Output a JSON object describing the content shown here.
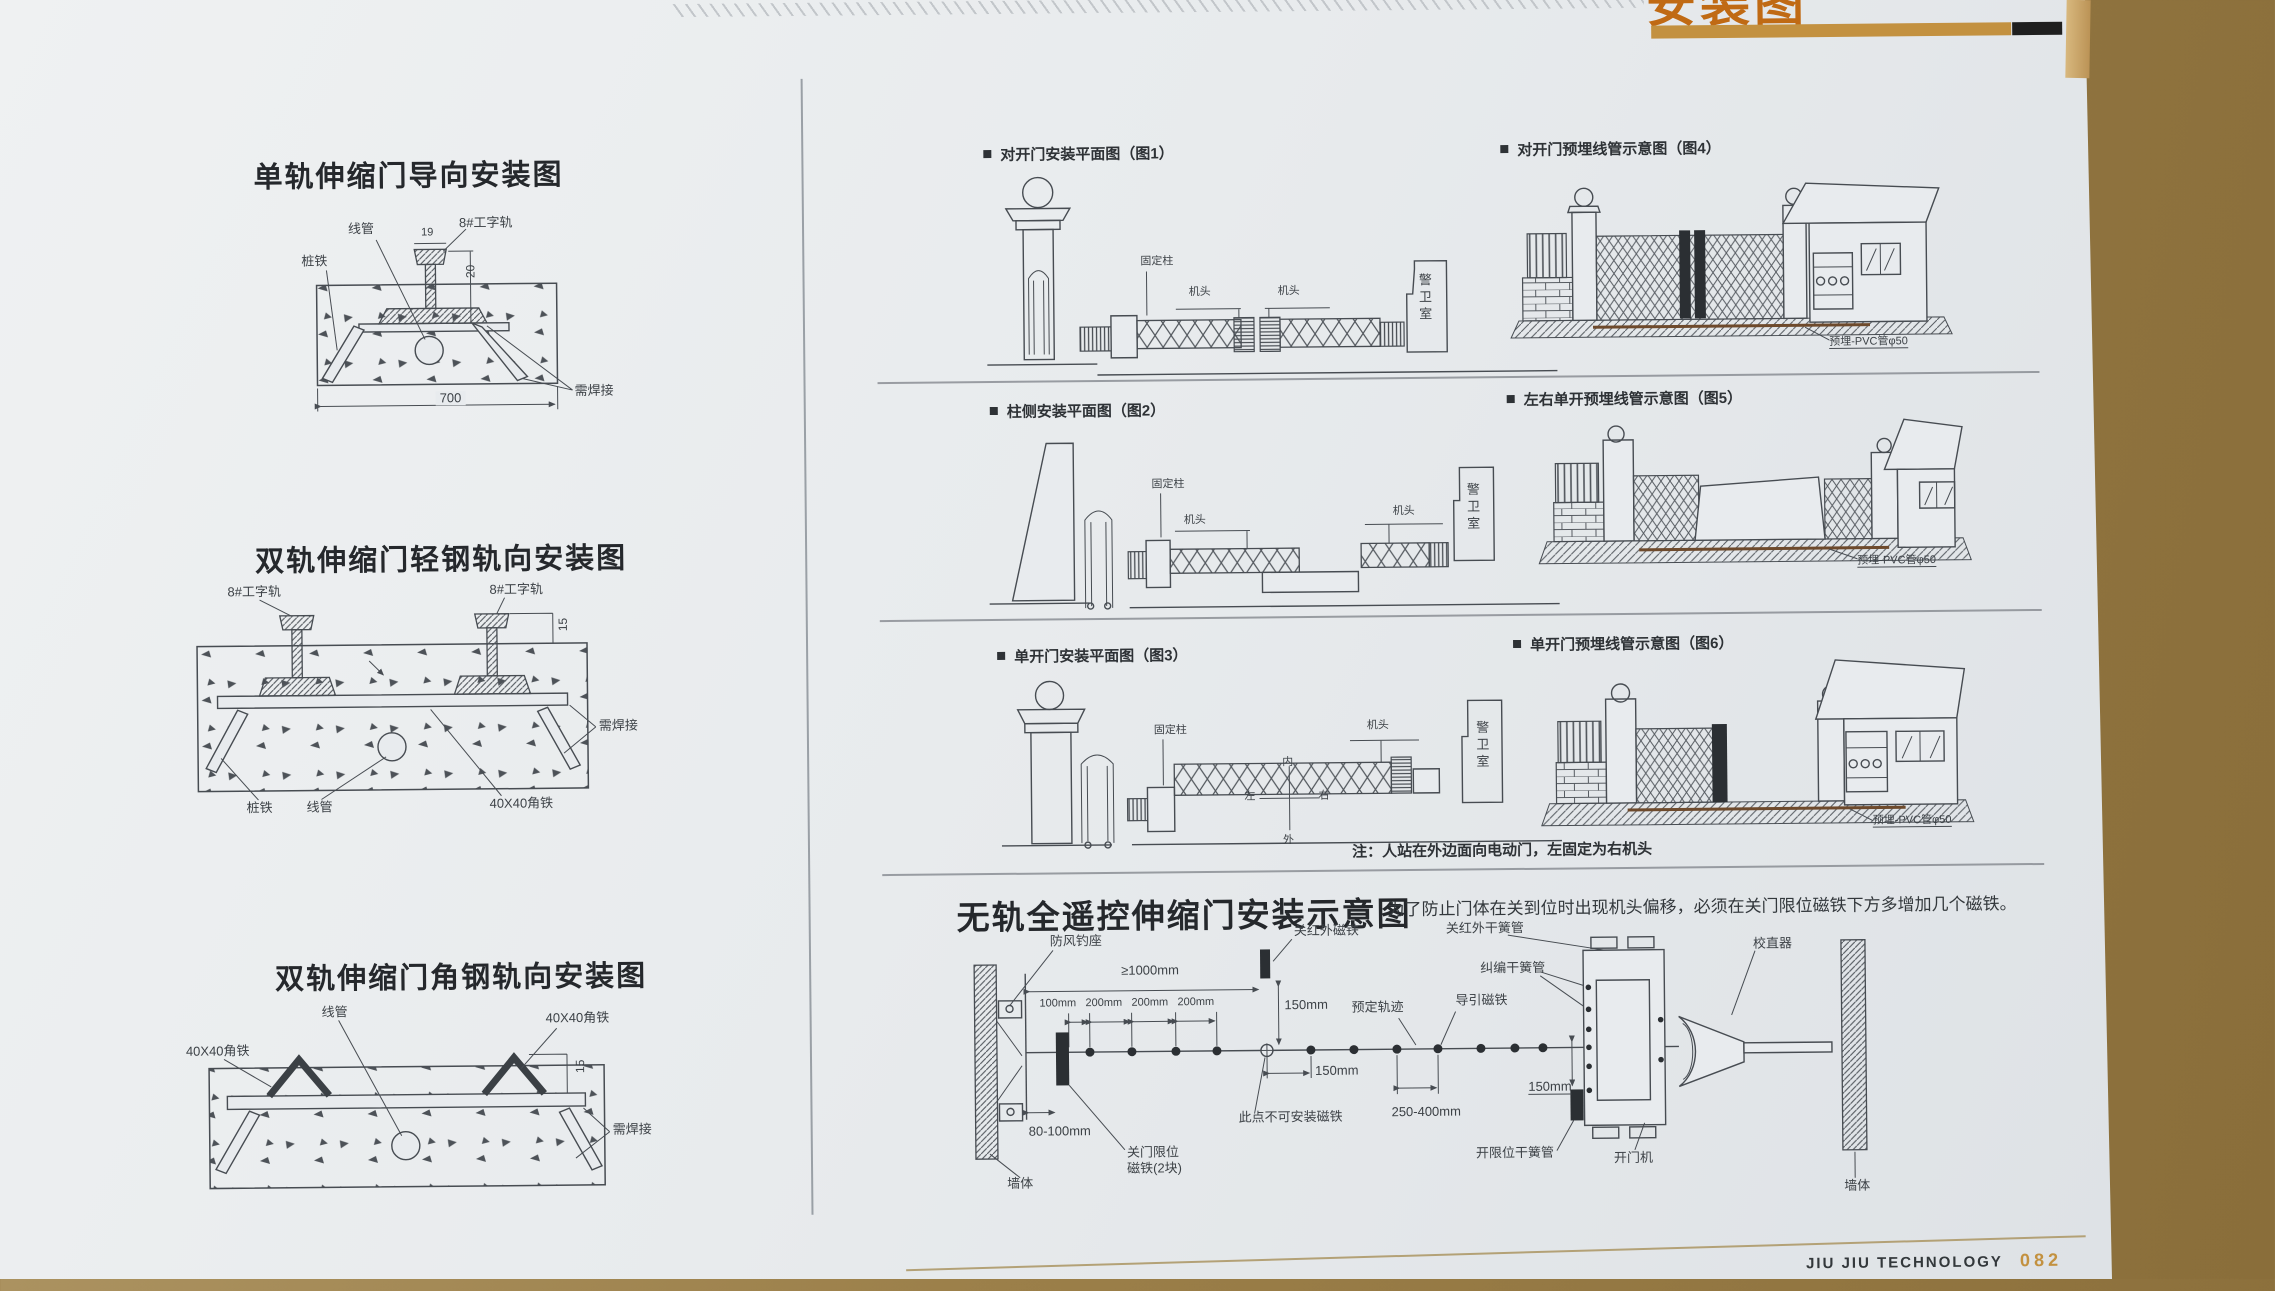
{
  "header": {
    "title_cn": "安装图",
    "title_en": "INSTALLATION DRAWINGS"
  },
  "footer": {
    "brand": "JIU JIU TECHNOLOGY",
    "page": "082"
  },
  "titles": {
    "d1": "单轨伸缩门导向安装图",
    "d2": "双轨伸缩门轻钢轨向安装图",
    "d3": "双轨伸缩门角钢轨向安装图",
    "main": "无轨全遥控伸缩门安装示意图",
    "tip": "为了防止门体在关到位时出现机头偏移，必须在关门限位磁铁下方多增加几个磁铁。",
    "note": "注：人站在外边面向电动门，左固定为右机头"
  },
  "figs": {
    "f1": "对开门安装平面图（图1）",
    "f2": "柱侧安装平面图（图2）",
    "f3": "单开门安装平面图（图3）",
    "f4": "对开门预埋线管示意图（图4）",
    "f5": "左右单开预埋线管示意图（图5）",
    "f6": "单开门预埋线管示意图（图6）"
  },
  "labels": {
    "xianguan": "线管",
    "zhuangtie": "桩铁",
    "igrail": "8#工字轨",
    "weld": "需焊接",
    "angle": "40X40角铁",
    "jitou": "机头",
    "gudingzhu": "固定柱",
    "jingweishi": "警卫室",
    "pvc": "预埋-PVC管φ50",
    "d19": "19",
    "d20": "20",
    "d700": "700",
    "d15": "15",
    "nei": "内",
    "wai": "外",
    "zuo": "左",
    "you": "右"
  },
  "bottom": {
    "fangfeng": "防风钓座",
    "guan_ir": "关红外磁铁",
    "guan_ir_reed": "关红外干簧管",
    "jiupian": "纠编干簧管",
    "xiaozhi": "校直器",
    "yuding": "预定轨迹",
    "daoyin": "导引磁铁",
    "cidian": "此点不可安装磁铁",
    "guanxianwei1": "关门限位",
    "guanxianwei2": "磁铁(2块)",
    "kaixianwei": "开限位干簧管",
    "kaimenji": "开门机",
    "qiangti": "墙体",
    "d1000": "≥1000mm",
    "d100": "100mm",
    "d200": "200mm",
    "d80": "80-100mm",
    "d150": "150mm",
    "d250": "250-400mm"
  }
}
